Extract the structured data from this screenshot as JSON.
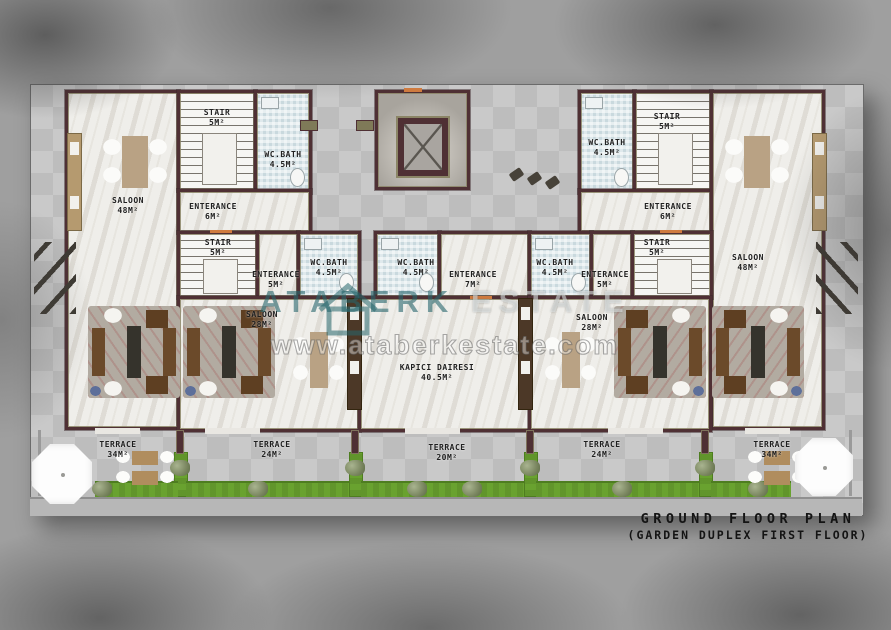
{
  "watermark": {
    "brand_primary": "ATABERK",
    "brand_secondary": "ESTATE",
    "url": "www.ataberkestate.com"
  },
  "title": {
    "line1": "GROUND FLOOR PLAN",
    "line2": "(GARDEN DUPLEX FIRST FLOOR)"
  },
  "rooms": {
    "tl_saloon": {
      "name": "SALOON",
      "area": "48M²"
    },
    "tl_stair": {
      "name": "STAIR",
      "area": "5M²"
    },
    "tl_wc": {
      "name": "WC.BATH",
      "area": "4.5M²"
    },
    "tl_ent": {
      "name": "ENTERANCE",
      "area": "6M²"
    },
    "tr_saloon": {
      "name": "SALOON",
      "area": "48M²"
    },
    "tr_stair": {
      "name": "STAIR",
      "area": "5M²"
    },
    "tr_wc": {
      "name": "WC.BATH",
      "area": "4.5M²"
    },
    "tr_ent": {
      "name": "ENTERANCE",
      "area": "6M²"
    },
    "ml_stair": {
      "name": "STAIR",
      "area": "5M²"
    },
    "ml_ent": {
      "name": "ENTERANCE",
      "area": "5M²"
    },
    "ml_wc": {
      "name": "WC.BATH",
      "area": "4.5M²"
    },
    "ml_saloon": {
      "name": "SALOON",
      "area": "28M²"
    },
    "c_wc": {
      "name": "WC.BATH",
      "area": "4.5M²"
    },
    "c_ent": {
      "name": "ENTERANCE",
      "area": "7M²"
    },
    "c_main": {
      "name": "KAPICI DAIRESI",
      "area": "40.5M²"
    },
    "mr_wc": {
      "name": "WC.BATH",
      "area": "4.5M²"
    },
    "mr_ent": {
      "name": "ENTERANCE",
      "area": "5M²"
    },
    "mr_stair": {
      "name": "STAIR",
      "area": "5M²"
    },
    "mr_saloon": {
      "name": "SALOON",
      "area": "28M²"
    },
    "t1": {
      "name": "TERRACE",
      "area": "34M²"
    },
    "t2": {
      "name": "TERRACE",
      "area": "24M²"
    },
    "t3": {
      "name": "TERRACE",
      "area": "20M²"
    },
    "t4": {
      "name": "TERRACE",
      "area": "24M²"
    },
    "t5": {
      "name": "TERRACE",
      "area": "34M²"
    }
  },
  "colors": {
    "wall": "#4f3034",
    "wall_accent": "#8b8566",
    "grass": "#69a22f",
    "bath_tile": "#dfe9ec",
    "watermark_teal": "#26666c",
    "title_text": "#141414"
  }
}
